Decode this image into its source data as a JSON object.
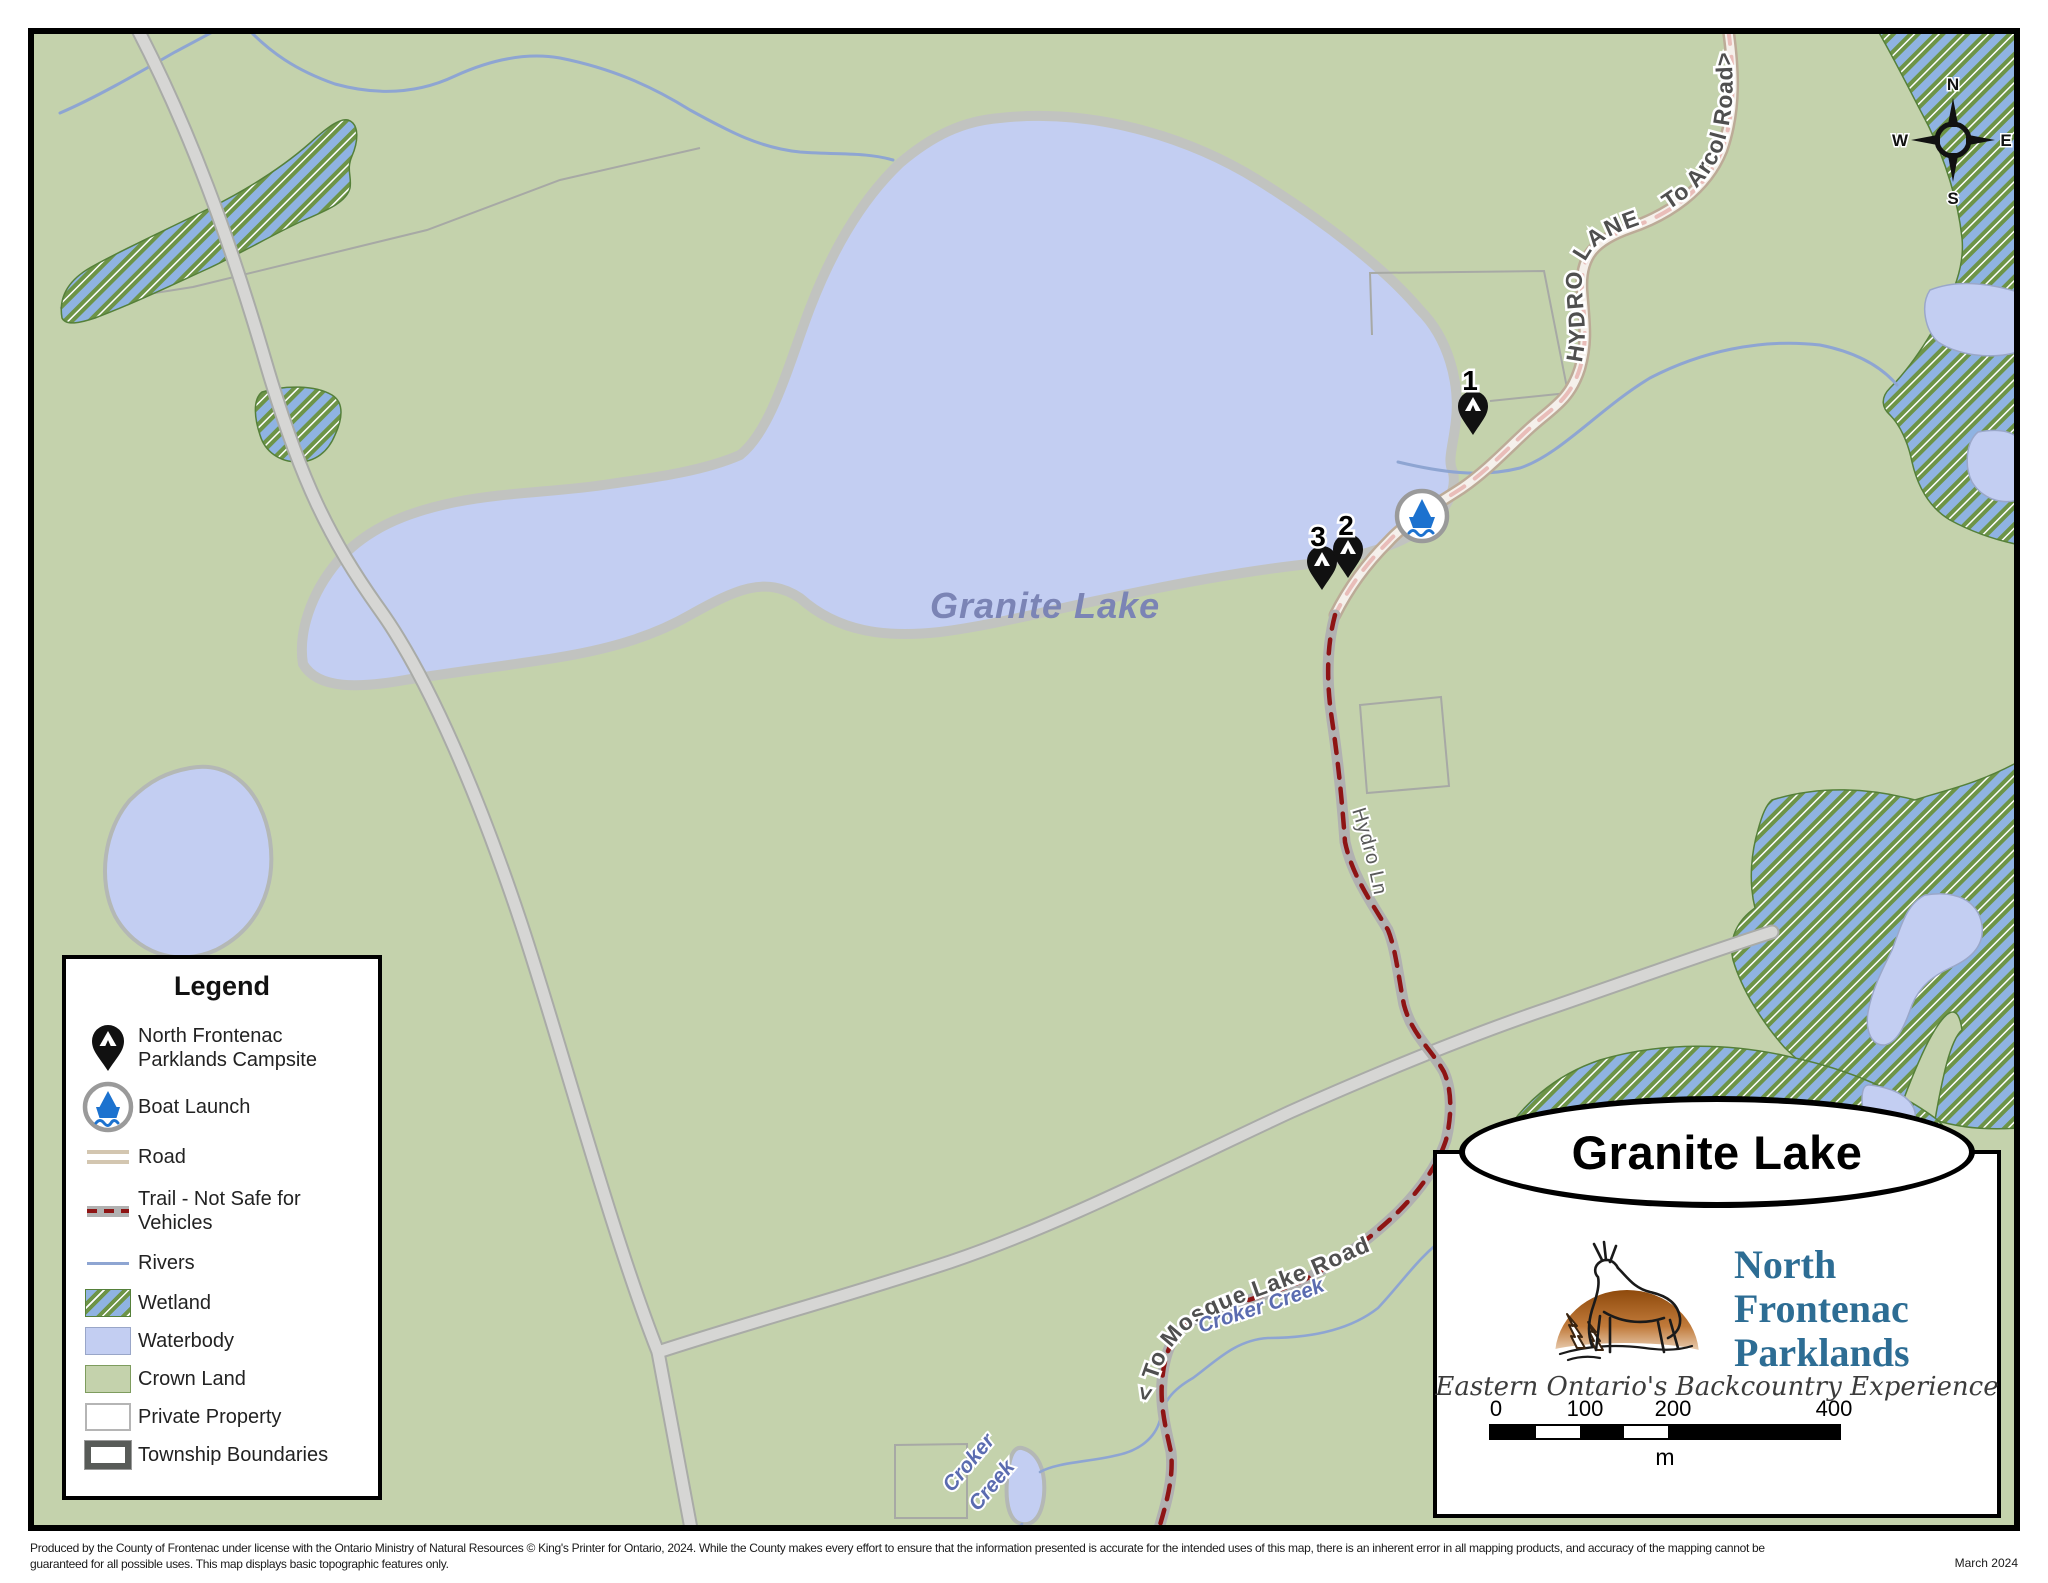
{
  "map": {
    "labels": {
      "lake_name": "Granite Lake",
      "road_hydro_lane": "HYDRO LANE",
      "road_to_arcol": "To Arcol Road>",
      "trail_hydro_ln": "Hydro Ln",
      "trail_to_mosque": "< To Mosque Lake Road",
      "creek_label_1": "Croker Creek",
      "creek_label_2_word1": "Croker",
      "creek_label_2_word2": "Creek"
    },
    "markers": {
      "campsite_1": "1",
      "campsite_2": "2",
      "campsite_3": "3"
    },
    "compass": {
      "n": "N",
      "e": "E",
      "s": "S",
      "w": "W"
    }
  },
  "legend": {
    "title": "Legend",
    "items": [
      {
        "type": "campsite-pin-icon",
        "label": "North Frontenac Parklands Campsite"
      },
      {
        "type": "boat-launch-icon",
        "label": "Boat Launch"
      },
      {
        "type": "road-swatch",
        "label": "Road"
      },
      {
        "type": "trail-swatch",
        "label": "Trail - Not Safe for Vehicles"
      },
      {
        "type": "rivers-swatch",
        "label": "Rivers"
      },
      {
        "type": "wetland-swatch",
        "label": "Wetland"
      },
      {
        "type": "waterbody-swatch",
        "label": "Waterbody"
      },
      {
        "type": "crown-land-swatch",
        "label": "Crown Land"
      },
      {
        "type": "private-property-swatch",
        "label": "Private Property"
      },
      {
        "type": "township-boundaries-swatch",
        "label": "Township Boundaries"
      }
    ]
  },
  "title_box": {
    "map_title": "Granite Lake",
    "logo": {
      "line1": "North",
      "line2": "Frontenac",
      "line3": "Parklands",
      "tagline": "Eastern Ontario's Backcountry Experience"
    },
    "scale_bar": {
      "labels": [
        "0",
        "100",
        "200",
        "400"
      ],
      "unit": "m"
    }
  },
  "footer": {
    "line1": "Produced by the County of Frontenac under license with the Ontario Ministry of Natural Resources © King's Printer for Ontario, 2024. While the County makes every effort to ensure that the information presented is accurate for the intended uses of this map, there is an inherent error in all mapping products, and accuracy of the mapping cannot be",
    "line2": "guaranteed for all possible uses. This map displays basic topographic features only.",
    "date": "March 2024"
  },
  "colors": {
    "crown_land": "#c4d2ac",
    "waterbody": "#c3cef2",
    "shoreline": "#c1c3c0",
    "wetland_blue": "#8fb3e2",
    "wetland_green": "#6d9447",
    "road_fill": "#d6d6d4",
    "hydro_lane_casing": "#bcab97",
    "hydro_lane_dash": "#e9bdb9",
    "trail_dash": "#8e1414",
    "river": "#8ea5d2",
    "lake_label": "#7b84b5",
    "logo_blue": "#2d6d94",
    "pin_black": "#111111",
    "boat_blue": "#1c72cf"
  }
}
